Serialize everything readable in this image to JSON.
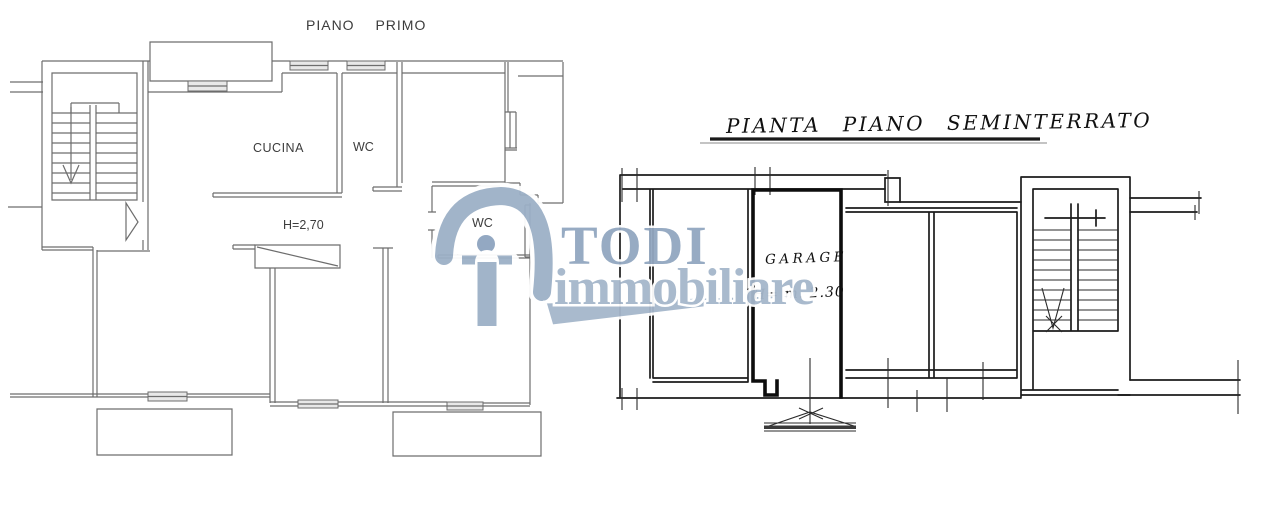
{
  "canvas": {
    "width": 1280,
    "height": 515,
    "background": "#ffffff"
  },
  "first_floor_plan": {
    "title": "PIANO PRIMO",
    "rooms": {
      "kitchen_label": "CUCINA",
      "wc_upper_label": "WC",
      "wc_lower_label": "WC"
    },
    "ceiling_height_note": "H=2,70"
  },
  "basement_plan": {
    "title": "PIANTA PIANO SEMINTERRATO",
    "rooms": {
      "garage_label": "GARAGE"
    },
    "ceiling_height_note": "H= m. 2.30"
  },
  "watermark": {
    "brand_name": "TODI",
    "brand_suffix": "immobiliare",
    "color_primary": "#92a7c0",
    "color_secondary": "#a5b7cb"
  }
}
